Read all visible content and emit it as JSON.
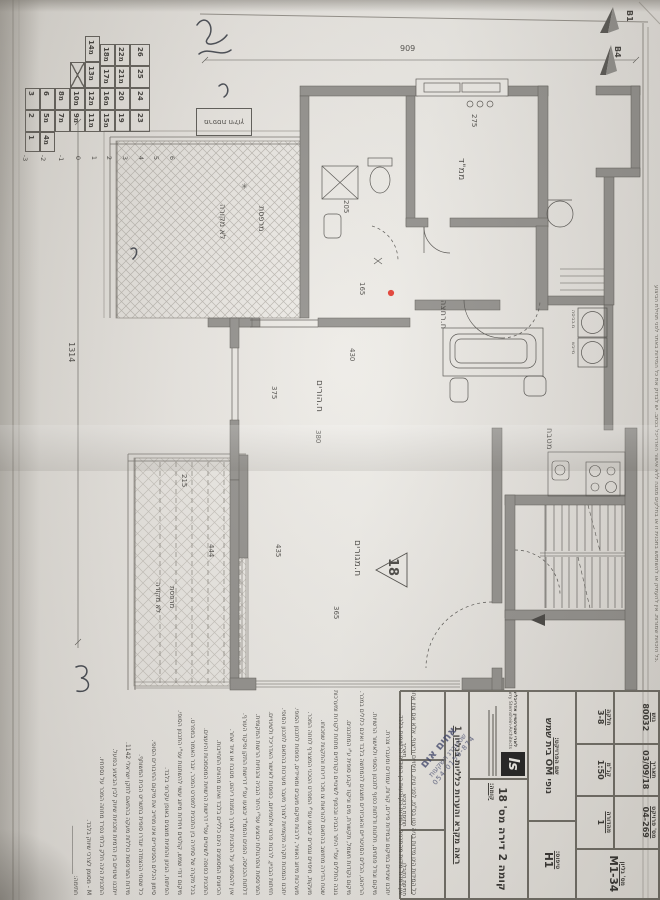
{
  "sheet": {
    "dim_width": "909",
    "dim_length": "1314"
  },
  "north": {
    "b1": "B1",
    "b4": "B4"
  },
  "key_plan": {
    "balcony_label": "מרפסת חילוץ",
    "cells": [
      "3",
      "2",
      "1",
      "6",
      "מ5",
      "מ4",
      "מ8",
      "מ7",
      "מ10",
      "מ9",
      "מ14",
      "מ13",
      "מ12",
      "מ11",
      "מ18",
      "מ17",
      "מ16",
      "מ15",
      "מ22",
      "מ21",
      "20",
      "19",
      "26",
      "25",
      "24",
      "23"
    ],
    "floors": [
      "-3",
      "-2",
      "-1",
      "0",
      "1",
      "2",
      "3",
      "4",
      "5",
      "6"
    ]
  },
  "plan": {
    "apartment_marker": "18",
    "rooms": {
      "mamad": "ממ\"ד",
      "master": "ח.הורים",
      "living": "ח.מגורים",
      "kitchen": "מטבח",
      "bath": "ח.רחצה",
      "balcony1_l1": "מרפסת",
      "balcony1_l2": "לא מקורה",
      "balcony2_l1": "מרפסת",
      "balcony2_l2": "לא מקורה",
      "washer": "מ.כביסה",
      "dryer": "מייבש"
    },
    "dims": {
      "d909": "909",
      "d1314": "1314",
      "d275": "275",
      "d205": "205",
      "d165": "165",
      "d375": "375",
      "d430": "430",
      "d380": "380",
      "d435": "435",
      "d365": "365",
      "d215": "215",
      "d444": "444"
    },
    "drain": "✳"
  },
  "title_block": {
    "fields": {
      "gush": {
        "label": "גוש",
        "value": "80032"
      },
      "helka": {
        "label": "חלקה",
        "value": "3-8"
      },
      "date": {
        "label": "תאריך",
        "value": "03/09/18"
      },
      "scale": {
        "label": "קנ\"מ",
        "value": "1:50"
      },
      "project_no": {
        "label": "מס' פרויקט",
        "value": "04-269"
      },
      "edition": {
        "label": "מהדורה",
        "value": "1"
      },
      "sheet_no": {
        "label": "מס' גליון",
        "value": "M1-34"
      },
      "project_name": {
        "label": "שם הפרויקט:",
        "value": "נופי OM בית שמש"
      },
      "type": {
        "label": "טיפוס:",
        "value": "H1"
      },
      "floor": {
        "label": "קומה:",
        "value": "קומה 2 דירה מס' 18"
      }
    },
    "see_note": "ראה מקרא והערות כלליות בגליון 1",
    "signatures": [
      "תאריך",
      "חתימת הרוכש",
      "חתימת הקבלן"
    ],
    "architect": {
      "logo": "ls",
      "name_he": "לארי שטרנשיין אדריכלים",
      "name_en": "Larry Sternshein-Architects"
    }
  },
  "stamp": {
    "line1": "אחים אום",
    "line2": "שטיינברג השקעות",
    "line3": "054-0156-874"
  },
  "edge_note": "כל הזכויות שמורות. אין להעתיק או להשתמש בתכנית זו או בחלקים ממנה ללא אישור האדריכל בכתב. יש לבדוק את כל המידות באתר לפני תחילת הביצוע.",
  "notes": {
    "lines": [
      "כל המידות הינן מידות בניה נטו בס\"מ, לפני טיח, חיפויים וריצוף, אלא אם צוין אחרת.",
      "אין למדוד מידות מהתכנית. המידות הקובעות הן המידות הרשומות בלבד.",
      "יתכנו שינויים במיקום ובמידות פירים, קורות, עמודים ומעברי צנרת.",
      "מיקום וגודל פתחים, חלונות ודלתות כפוף לתכנון הסופי ולאישור הרשויות.",
      "הריהוט, הכלים הסניטריים והאביזרים מוצגים להמחשה בלבד ואינם כלולים במכר.",
      "מיקום נקודות חשמל, תקשורת, מים וניקוז יקבע סופית ע\"י המתכננים.",
      "גובה החללים עפ\"י היתר הבניה ובכפוף לשינויים נקודתיים מתחת לקורות ומערכות.",
      "שטח הדירה מחושב בהתאם להוראות צו מכר דירות והתקנות שמכוחו.",
      "מעקות, חיפויים וגמרים יבוצעו עפ\"י המפרט הטכני המצורף לחוזה המכר.",
      "מערכות מיזוג האוויר, לרבות מיקום מעבים ומאיידים, כפופות לתכנון הסופי.",
      "יתכנו הנמכות תקרה מקומיות לצורך מעבר מערכות בהתאם לתכנון הסופי.",
      "חזיתות הבניין, לרבות פרטי אלומיניום, כפופות לאישור האדריכל ולשינויים.",
      "המרפסות והפרגולות יבוצעו עפ\"י היתר הבניה והנחיות הרשות המקומית.",
      "דלתות הכניסה, הפנים והממ\"ד יבוצעו עפ\"י דרישות התקן ופיקוד העורף.",
      "אין להסתמך על התכנית לצורך הזמנת ריהוט, מטבח או ציוד אחר.",
      "הכיוונים המסומנים הינם כלליים בלבד ואינם מהווים התחייבות.",
      "התכנית כפופה לשינויים עפ\"י דרישות הרשויות המוסמכות והיועצים.",
      "בכל מקרה של סתירה בין התכנית למפרט המכר, יגבר האמור במפרט.",
      "מיקום דודי שמש, קולטים ויחידות מיזוג עשוי להשתנות עפ\"י התכנון הסופי.",
      "הפיתוח, הגינון והחניות מוצגים באופן עקרוני בלבד.",
      "סימון הכלים הסניטריים אינו מחייב את מיקום החיבורים הסופי.",
      "כל שטחי ההצמדה יוגדרו סופית בתשריט הבית המשותף.",
      "מידות המרפסות כוללות מעקה בהתאם לתקן ישראלי 1142.",
      "ייתכנו שינויים בין הדמיות ותכניות שיווק לבין הביצוע בפועל.",
      "התכנית הינה חלק בלתי נפרד מחוזה המכר על נספחיו.",
      "M - מסומן לצרכי שיווק בלבד.",
      "חתימה: ________________"
    ]
  }
}
